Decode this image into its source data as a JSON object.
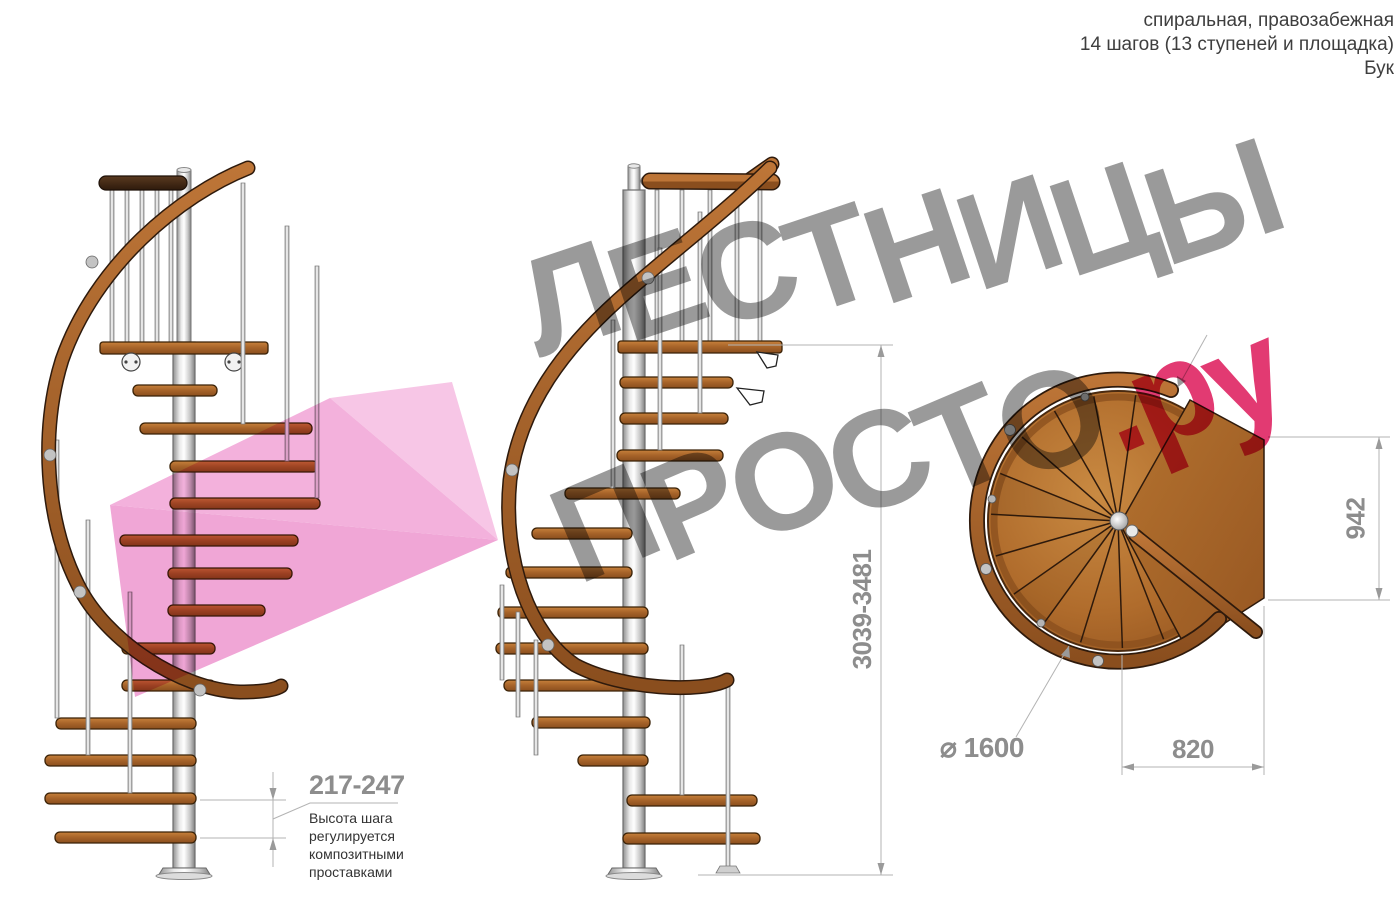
{
  "title_block": {
    "type_line": "спиральная, правозабежная",
    "steps_line": "14 шагов (13 ступеней и площадка)",
    "material_line": "Бук"
  },
  "watermark": {
    "word1": "ЛЕСТНИЦЫ",
    "word2": "ПРОСТО",
    "domain_suffix": ".ру"
  },
  "dimensions": {
    "total_height_range": "3039-3481",
    "step_height_range": "217-247",
    "step_note_line1": "Высота шага",
    "step_note_line2": "регулируется",
    "step_note_line3": "композитными",
    "step_note_line4": "проставками",
    "landing_width": "942",
    "landing_depth": "820",
    "diameter": "⌀ 1600"
  },
  "colors": {
    "wood": "#a9612e",
    "wood_dark": "#6e3c16",
    "pole_metal": "#d9d9d9",
    "watermark_gray": "#9a9a9a",
    "watermark_pink": "#e23a72",
    "dimension_gray": "#8d8d8d",
    "arrow_pink": "#f3b1dc"
  }
}
